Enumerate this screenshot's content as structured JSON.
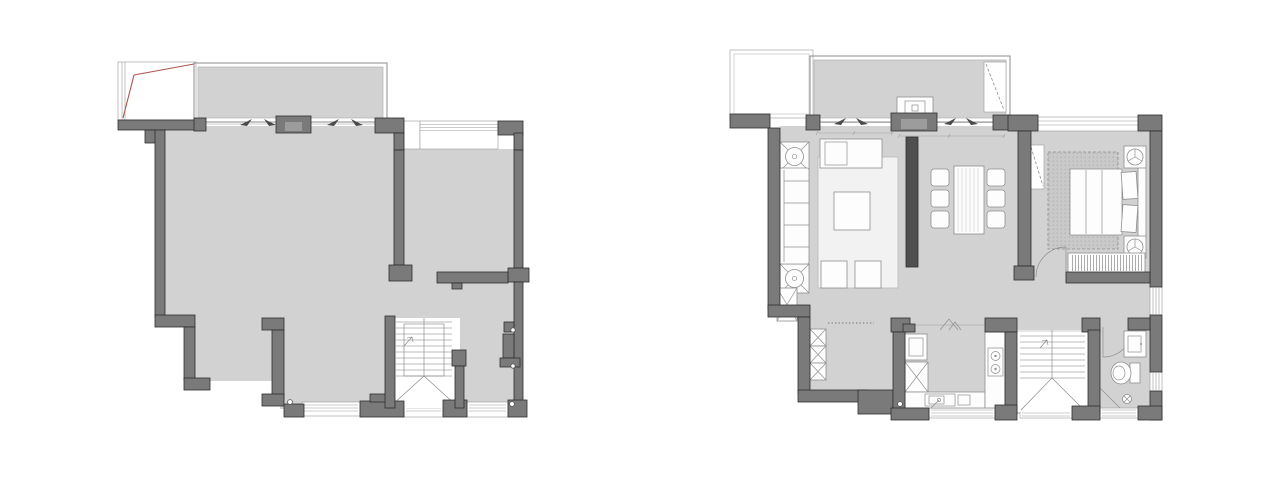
{
  "page": {
    "background": "#ffffff",
    "description": "Two residential floor plans side by side: left structural plan (unfurnished), right furnished layout plan"
  },
  "colors": {
    "background": "#ffffff",
    "floor": "#d2d2d2",
    "wall": "#7a7a7a",
    "wall-stroke": "#2e2e2e",
    "thin-line": "#9a9a9a",
    "furniture-fill": "#fdfdfd",
    "furniture-stroke": "#8f8f8f",
    "rug-fill": "#f2f2f2",
    "bed-rug-fill": "#c9c9c9",
    "dark-feature": "#4f4f4f",
    "accent-red": "#ae544e",
    "stair-line": "#7f7f7f"
  },
  "plans": [
    {
      "name": "structural-plan",
      "elements": [
        "open-terrace-with-red-roofline",
        "balcony",
        "sliding-door-wall",
        "main-room",
        "side-room",
        "bay-window",
        "staircase",
        "door-hinge-circles",
        "bottom-windows"
      ]
    },
    {
      "name": "furnished-plan",
      "rooms": [
        "terrace",
        "balcony",
        "living-room",
        "dining-area",
        "bedroom",
        "hallway",
        "kitchen",
        "staircase",
        "bathroom"
      ],
      "furniture": [
        "sofa",
        "chaise",
        "area-rug",
        "coffee-table",
        "ottomans",
        "potted-plants",
        "tv-console",
        "dining-table",
        "dining-chairs",
        "bed",
        "pillows",
        "nightstand-lamps",
        "bedroom-rug",
        "wardrobe",
        "mirror-panel",
        "shoe-cabinets",
        "refrigerator",
        "kitchen-counter",
        "kitchen-sink",
        "cooktop",
        "washing-machine",
        "vanity-sink",
        "toilet",
        "shower-drain"
      ]
    }
  ],
  "symbols": {
    "plant": "square-box-with-crossed-circle",
    "ceiling-lamp": "circle-with-y-spokes",
    "floor-drain": "circle-with-cross",
    "stair-direction": "v-diagonals-with-arrow",
    "door-swing": "quarter-arc",
    "window": "triple-parallel-lines"
  }
}
